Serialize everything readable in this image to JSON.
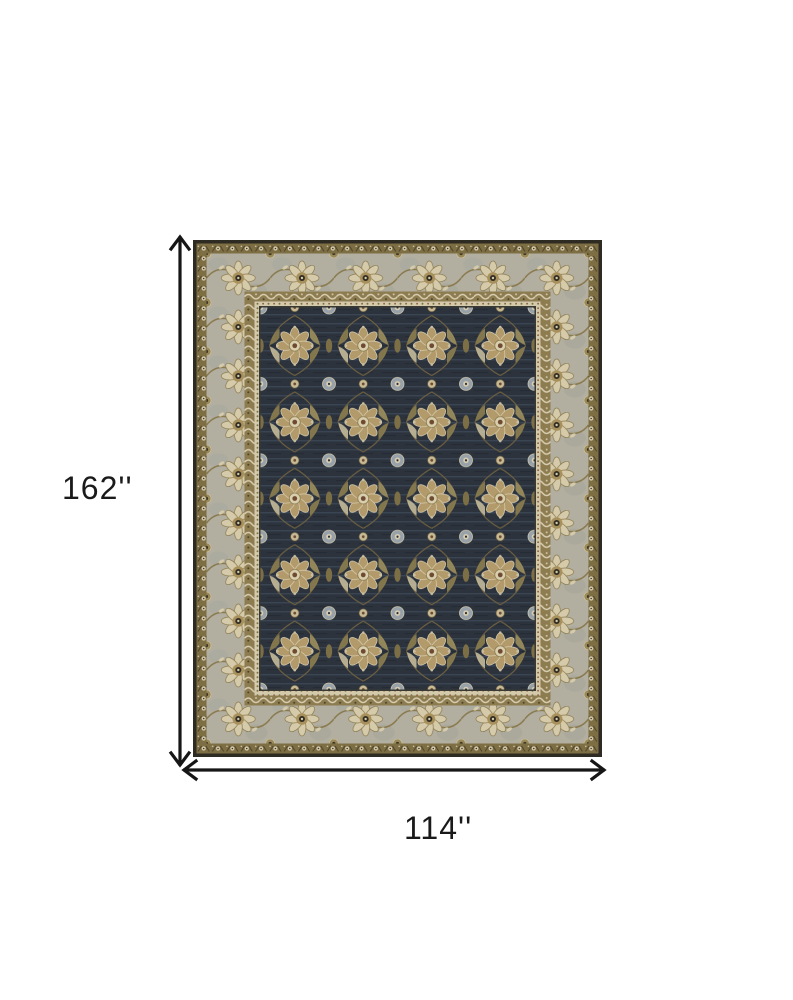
{
  "diagram": {
    "title": "rug-dimension-diagram",
    "background": "#ffffff",
    "height_label": "162''",
    "width_label": "114''",
    "arrow_color": "#161616",
    "height_arrow_icon": "double-headed-vertical-arrow",
    "width_arrow_icon": "double-headed-horizontal-arrow"
  },
  "rug": {
    "description": "Traditional oriental area rug: dark charcoal-navy field with gold and cream floral medallions, sage-grey ornamental border with olive guard bands",
    "colors": {
      "edge_dark": "#2e2b23",
      "band_olive_outer": "#7d6e44",
      "border_grey": "#b2aea0",
      "band_olive_inner": "#8d7c50",
      "guard_cream": "#d3c9ab",
      "inner_line_dark": "#3a3a32",
      "field_navy": "#2c333d",
      "field_streak": "#4a5868",
      "motif_tan": "#b29a6a",
      "motif_cream": "#d8cdb0",
      "motif_bluegrey": "#97a1aa",
      "motif_olive": "#7d6f45",
      "motif_rust": "#6e4a30",
      "motif_dark": "#262b33"
    }
  }
}
